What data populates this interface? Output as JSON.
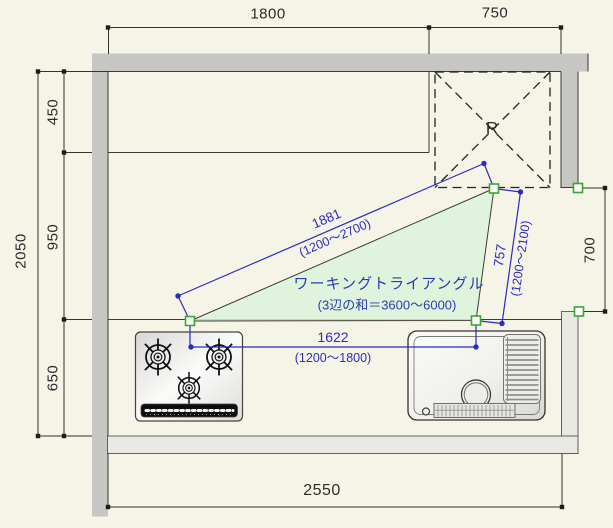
{
  "plan": {
    "refrigerator_label": "R",
    "triangle": {
      "title": "ワーキングトライアングル",
      "subtitle": "(3辺の和＝3600〜6000)",
      "sides": {
        "stove_fridge": {
          "length": "1881",
          "range": "(1200〜2700)"
        },
        "fridge_sink": {
          "length": "757",
          "range": "(1200〜2100)"
        },
        "sink_stove": {
          "length": "1622",
          "range": "(1200〜1800)"
        }
      }
    },
    "dimensions": {
      "top_counter_width": "1800",
      "refrigerator_width": "750",
      "left_total": "2050",
      "upper_counter_depth": "450",
      "middle_clearance": "950",
      "lower_counter_depth": "650",
      "right_opening_width": "700",
      "bottom_interior_width": "2550"
    },
    "colors": {
      "background": "#f6f3e7",
      "wall": "#c6c6c3",
      "light_wall": "#e9e9e4",
      "triangle_fill": "#dcf3da",
      "dimension_blue": "#2b2bc0",
      "marker_green": "#3aa53a",
      "dim_text": "#2b2b2b"
    }
  }
}
